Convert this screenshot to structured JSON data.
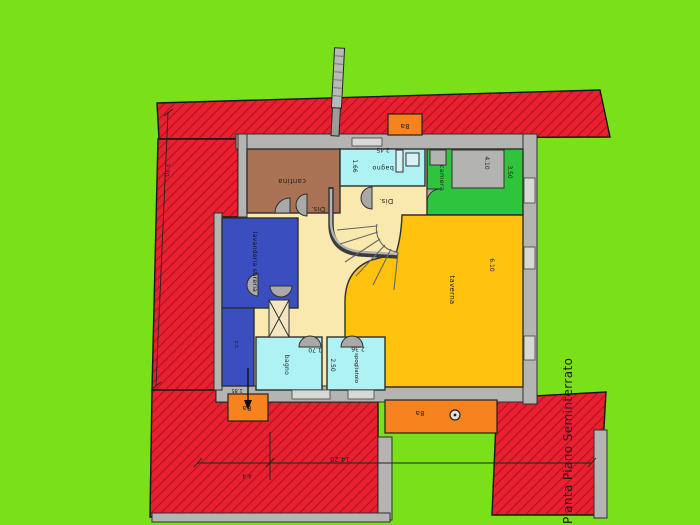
{
  "title": {
    "text": "Pianta Piano Seminterrato"
  },
  "rooms": {
    "cantina": {
      "label": "cantina"
    },
    "bagno_top": {
      "label": "bagno",
      "dim_width": "2.45",
      "dim_left": "1.66"
    },
    "camera": {
      "label": "camera",
      "dim_width": "4.10",
      "dim_depth": "3.50"
    },
    "dis_1": {
      "label": "Dis."
    },
    "dis_2": {
      "label": "Dis."
    },
    "lavanderia": {
      "label": "lavanderia stireria"
    },
    "locale_tecnico": {
      "label": "c.t."
    },
    "bagno_bottom": {
      "label": "bagno",
      "dim_width": "1.70"
    },
    "spogliatoio": {
      "label": "spogliatoio",
      "dim_width": "2.36",
      "dim_depth": "2.50"
    },
    "taverna": {
      "label": "taverna",
      "dim_depth": "6.10"
    }
  },
  "shafts": {
    "top": {
      "label": "8a"
    },
    "left": {
      "label": "8a"
    },
    "bottom_strip": {
      "label": "8a"
    }
  },
  "site_dimensions": {
    "overall_width": "14.20",
    "left_offset": "4.4",
    "left_side": "3.70",
    "laundry_width": "1.85"
  },
  "colors": {
    "background_green": "#79E01A",
    "terrain_red": "#E8202F",
    "hatch_red": "#AF1220",
    "wall_grey": "#B4B4B3",
    "hall_cream": "#FAE9AE",
    "cantina_brown": "#AA7254",
    "bath_cyan": "#AEF2F4",
    "camera_green": "#2EC43B",
    "laundry_blue": "#3A4EC0",
    "taverna_yellow": "#FFC20F",
    "shaft_orange": "#F6831E"
  }
}
